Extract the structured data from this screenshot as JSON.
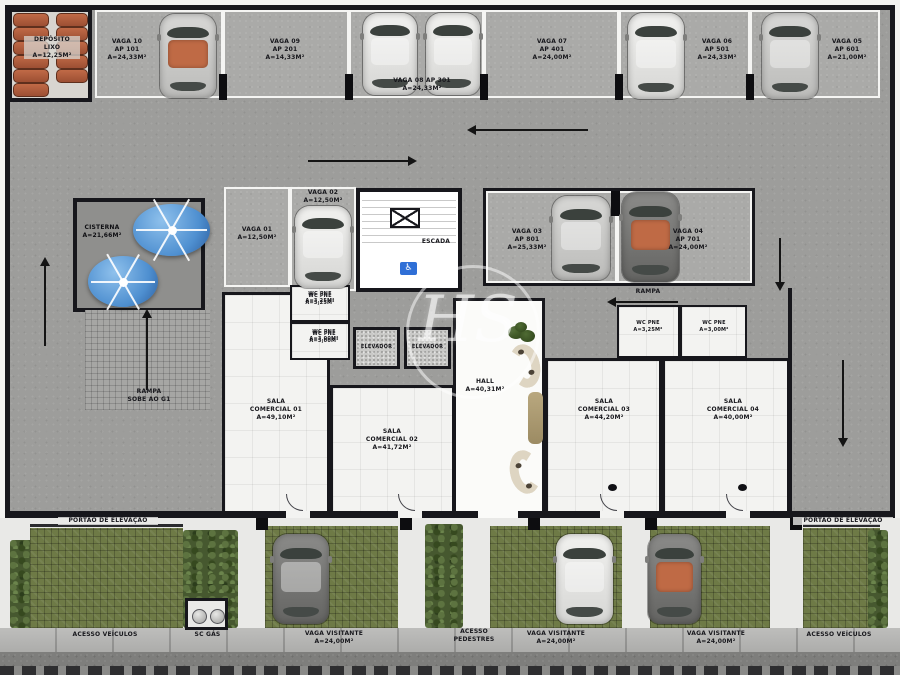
{
  "watermark": "HS",
  "colors": {
    "water_tank": "#4e8fd0",
    "car_accent_roof": "#bf6a45",
    "grass_paver": "#6e7a46",
    "handicap_blue": "#2f6fd6",
    "wall": "#17171c"
  },
  "garage": {
    "deposito": "DEPÓSITO\nLIXO\nA=12,25m²",
    "top_spots": [
      {
        "label": "VAGA 10\nAP 101\nA=24,33m²"
      },
      {
        "label": "VAGA 09\nAP 201\nA=14,33m²"
      },
      {
        "label": "VAGA 08 AP 301\nA=24,33m²"
      },
      {
        "label": "VAGA 07\nAP 401\nA=24,00m²"
      },
      {
        "label": "VAGA 06\nAP 501\nA=24,33m²"
      },
      {
        "label": "VAGA 05\nAP 601\nA=21,00m²"
      }
    ],
    "cisterna": "CISTERNA\nA=21,66m²",
    "vaga01": "VAGA 01\nA=12,50m²",
    "vaga02": "VAGA 02\nA=12,50m²",
    "escada": "ESCADA",
    "vaga03": "VAGA 03\nAP 801\nA=25,33m²",
    "vaga04": "VAGA 04\nAP 701\nA=24,00m²",
    "rampa": "RAMPA",
    "rampa_sobe": "RAMPA\nSOBE AO G1"
  },
  "rooms": {
    "wc_left_1": "WC PNE\nA=3,25m²",
    "wc_left_2": "WC PNE\nA=3,00m²",
    "elevador": "ELEVADOR",
    "hall": "HALL\nA=40,31m²",
    "wc_right_1": "WC PNE\nA=3,25m²",
    "wc_right_2": "WC PNE\nA=3,00m²",
    "sala01": "SALA\nCOMERCIAL 01\nA=49,10m²",
    "sala02": "SALA\nCOMERCIAL 02\nA=41,72m²",
    "sala03": "SALA\nCOMERCIAL 03\nA=44,20m²",
    "sala04": "SALA\nCOMERCIAL 04\nA=40,00m²"
  },
  "exterior": {
    "portao_left": "PORTÃO DE ELEVAÇÃO",
    "portao_right": "PORTÃO DE ELEVAÇÃO",
    "acesso_veiculos_left": "ACESSO VEÍCULOS",
    "sc_gas": "SC GÁS",
    "visitante_1": "VAGA VISITANTE\nA=24,00m²",
    "acesso_pedestres": "ACESSO\nPEDESTRES",
    "visitante_2": "VAGA VISITANTE\nA=24,00m²",
    "visitante_3": "VAGA VISITANTE\nA=24,00m²",
    "acesso_veiculos_right": "ACESSO VEÍCULOS"
  }
}
